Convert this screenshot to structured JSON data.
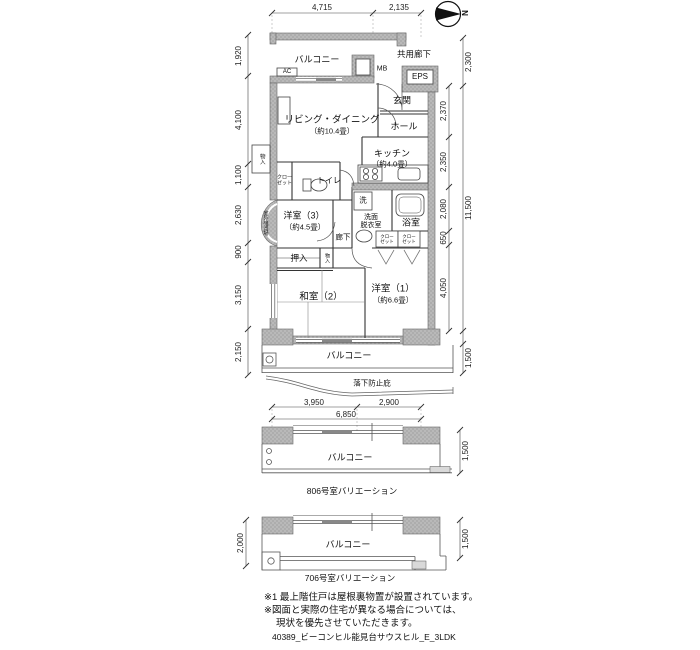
{
  "colors": {
    "wall_fill": "#b9b9b9",
    "wall_dot": "#8f8f8f",
    "line": "#333333",
    "sash": "#888888"
  },
  "compass": {
    "north": "N"
  },
  "plan": {
    "balcony_top": "バルコニー",
    "ac": "AC",
    "mb": "MB",
    "common_corridor": "共用廊下",
    "eps": "EPS",
    "entrance": "玄関",
    "hall": "ホール",
    "living": "リビング・ダイニング",
    "living_size": "（約10.4畳）",
    "kitchen": "キッチン",
    "kitchen_size": "（約4.0畳）",
    "toilet": "トイレ",
    "closet_l1": "クロー",
    "closet_l2": "ゼット",
    "storage": "物入",
    "outdoor_unit": "室外機置場",
    "west3": "洋室（3）",
    "west3_size": "（約4.5畳）",
    "wash": "洗",
    "washroom_l1": "洗面",
    "washroom_l2": "脱衣室",
    "bathroom": "浴室",
    "corridor": "廊下",
    "oshiire": "押入",
    "japanese2": "和室（2）",
    "west1": "洋室（1）",
    "west1_size": "（約6.6畳）",
    "balcony_bottom": "バルコニー",
    "fall_guard": "落下防止庇"
  },
  "dims": {
    "top": [
      "4,715",
      "2,135"
    ],
    "left": [
      "1,920",
      "4,100",
      "1,100",
      "2,630",
      "900",
      "3,150",
      "2,150"
    ],
    "right": [
      "2,300",
      "2,370",
      "2,350",
      "2,080",
      "650",
      "4,050",
      "11,500",
      "1,500"
    ],
    "bottom": [
      "3,950",
      "2,900",
      "6,850"
    ]
  },
  "v806": {
    "caption": "806号室バリエーション",
    "balcony": "バルコニー",
    "right": "1,500"
  },
  "v706": {
    "caption": "706号室バリエーション",
    "balcony": "バルコニー",
    "left": "2,000",
    "right": "1,500"
  },
  "notes": [
    "※1 最上階住戸は屋根裏物置が設置されています。",
    "※図面と実際の住宅が異なる場合については、",
    "現状を優先させていただきます。"
  ],
  "footer": "40389_ビーコンヒル能見台サウスヒル_E_3LDK"
}
